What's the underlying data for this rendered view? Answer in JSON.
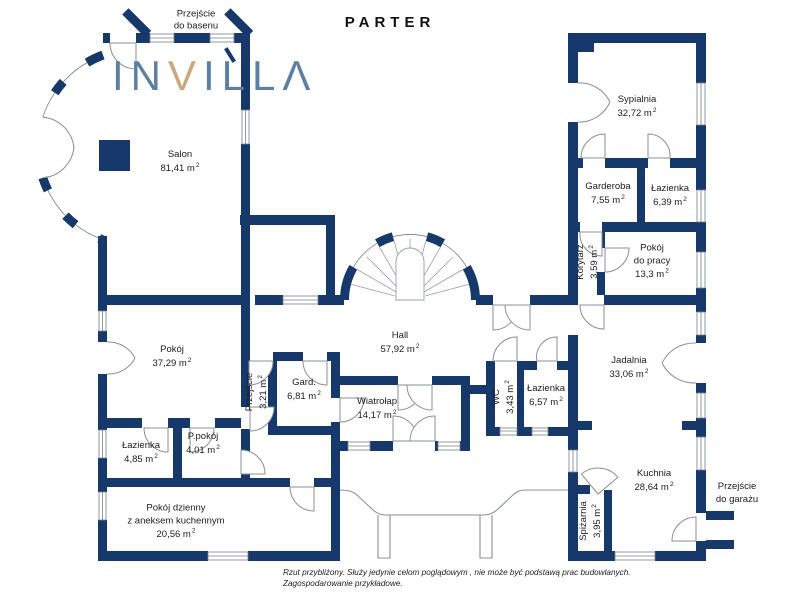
{
  "title": "PARTER",
  "logo": {
    "part1": "IN",
    "accent_letter": "V",
    "part2": "ILLΛ"
  },
  "sup": "2",
  "annotations": {
    "pool": [
      "Przejście",
      "do basenu"
    ],
    "garage": [
      "Przejście",
      "do garażu"
    ]
  },
  "rooms": {
    "salon": {
      "name": "Salon",
      "area": "81,41 m"
    },
    "sypialnia": {
      "name": "Sypialnia",
      "area": "32,72 m"
    },
    "garderoba": {
      "name": "Garderoba",
      "area": "7,55 m"
    },
    "lazienka_gora": {
      "name": "Łazienka",
      "area": "6,39 m"
    },
    "korytarz": {
      "name": "Korytarz",
      "area": "3,59 m"
    },
    "pokoj_do_pracy": {
      "name": "Pokój",
      "name2": "do pracy",
      "area": "13,3 m"
    },
    "hall": {
      "name": "Hall",
      "area": "57,92 m"
    },
    "pokoj": {
      "name": "Pokój",
      "area": "37,29 m"
    },
    "przejscie": {
      "name": "Przejście",
      "area": "3,21 m"
    },
    "gard": {
      "name": "Gard.",
      "area": "6,81 m"
    },
    "wiatrolap": {
      "name": "Wiatrołap",
      "area": "14,17 m"
    },
    "wc": {
      "name": "WC",
      "area": "3,43 m"
    },
    "lazienka_hall": {
      "name": "Łazienka",
      "area": "6,57 m"
    },
    "jadalnia": {
      "name": "Jadalnia",
      "area": "33,06 m"
    },
    "lazienka_dol": {
      "name": "Łazienka",
      "area": "4,85 m"
    },
    "p_pokoj": {
      "name": "P.pokój",
      "area": "4,01 m"
    },
    "pokoj_dzienny": {
      "name": "Pokój dzienny",
      "name2": "z aneksem kuchennym",
      "area": "20,56 m"
    },
    "kuchnia": {
      "name": "Kuchnia",
      "area": "28,64 m"
    },
    "spizarnia": {
      "name": "Spiżarnia",
      "area": "3,95 m"
    }
  },
  "footer": {
    "line1": "Rzut przybliżony. Służy jedynie celom poglądowym , nie może być podstawą prac budowlanych.",
    "line2": "Zagospodarowanie przykładowe."
  },
  "colors": {
    "wall": "#17386b",
    "logo_blue": "#5d7fa4",
    "logo_tan": "#c9a87e",
    "door_line": "#8b9095",
    "text": "#1c1c1c"
  }
}
